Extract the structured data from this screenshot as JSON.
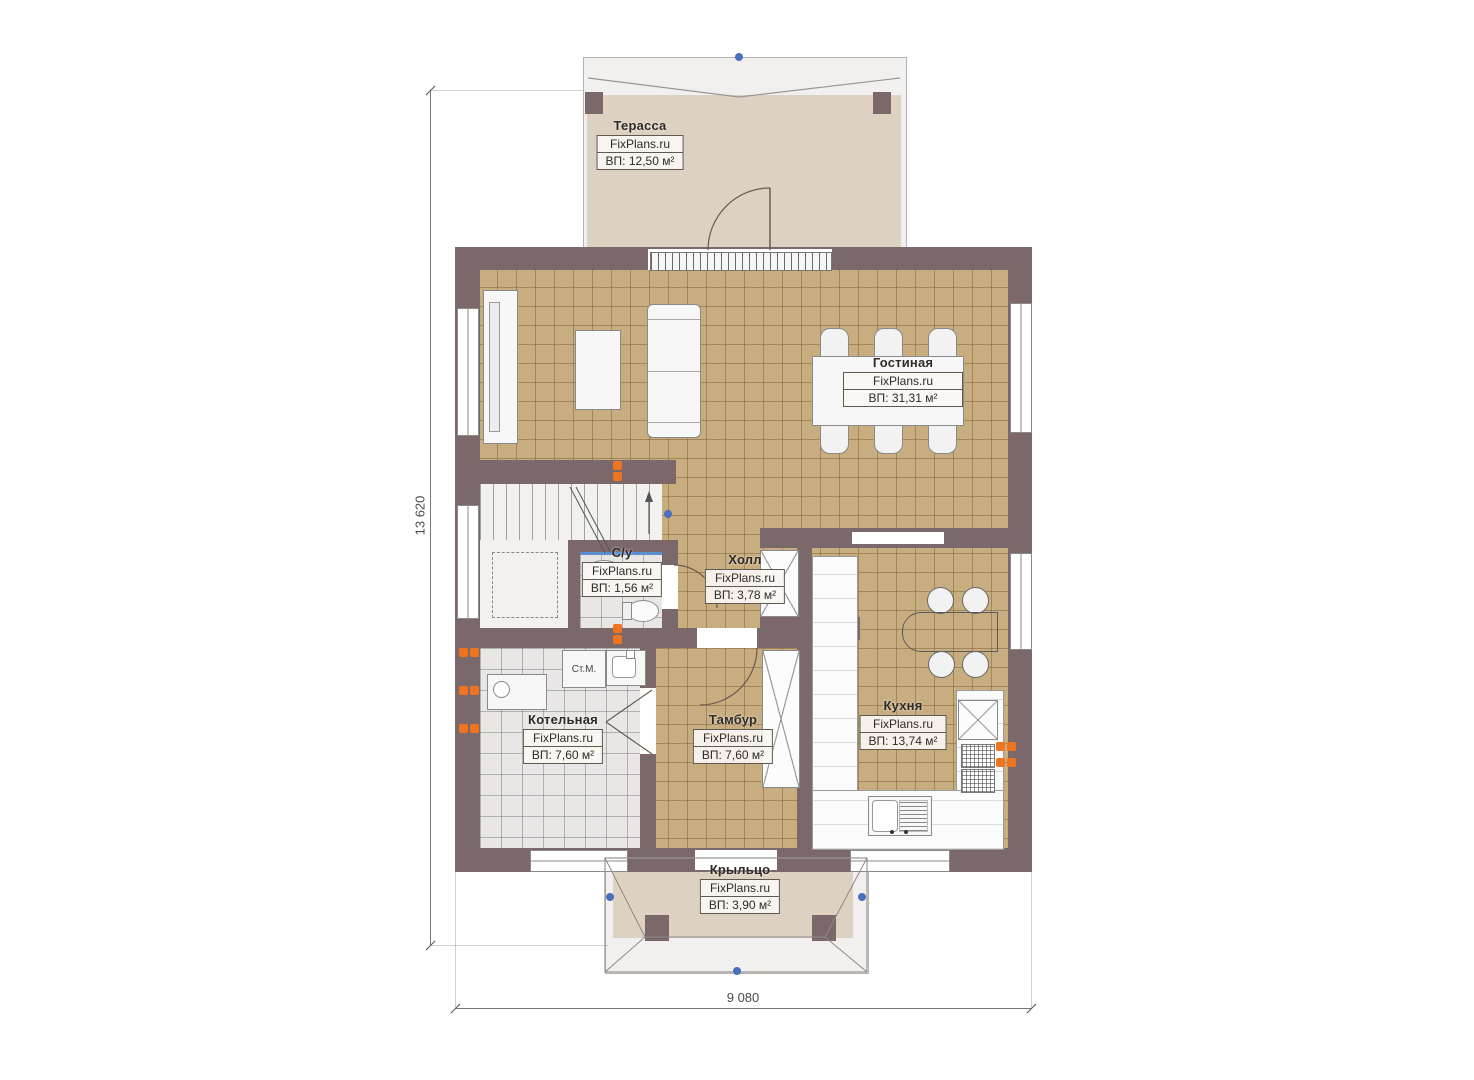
{
  "plan": {
    "watermark": "FixPlans.ru",
    "rooms": [
      {
        "id": "terrace",
        "name": "Терасса",
        "area": "ВП: 12,50 м²"
      },
      {
        "id": "living_room",
        "name": "Гостиная",
        "area": "ВП: 31,31 м²"
      },
      {
        "id": "bathroom",
        "name": "С/у",
        "area": "ВП: 1,56 м²"
      },
      {
        "id": "hall",
        "name": "Холл",
        "area": "ВП: 3,78 м²"
      },
      {
        "id": "boiler_room",
        "name": "Котельная",
        "area": "ВП: 7,60 м²"
      },
      {
        "id": "vestibule",
        "name": "Тамбур",
        "area": "ВП: 7,60 м²"
      },
      {
        "id": "kitchen",
        "name": "Кухня",
        "area": "ВП: 13,74 м²"
      },
      {
        "id": "porch",
        "name": "Крыльцо",
        "area": "ВП: 3,90 м²"
      }
    ],
    "fixtures": {
      "washing_machine": "Ст.М."
    },
    "dimensions": {
      "overall_height_mm": "13 620",
      "overall_width_mm": "9 080"
    },
    "colors": {
      "wall": "#7b686b",
      "floor_tile_tan": "#c8ad80",
      "floor_tile_gray": "#e8e7e5",
      "floor_beige": "#ddd1c1",
      "radiator_orange": "#ef7420",
      "marker_blue": "#4a6fbe"
    }
  }
}
